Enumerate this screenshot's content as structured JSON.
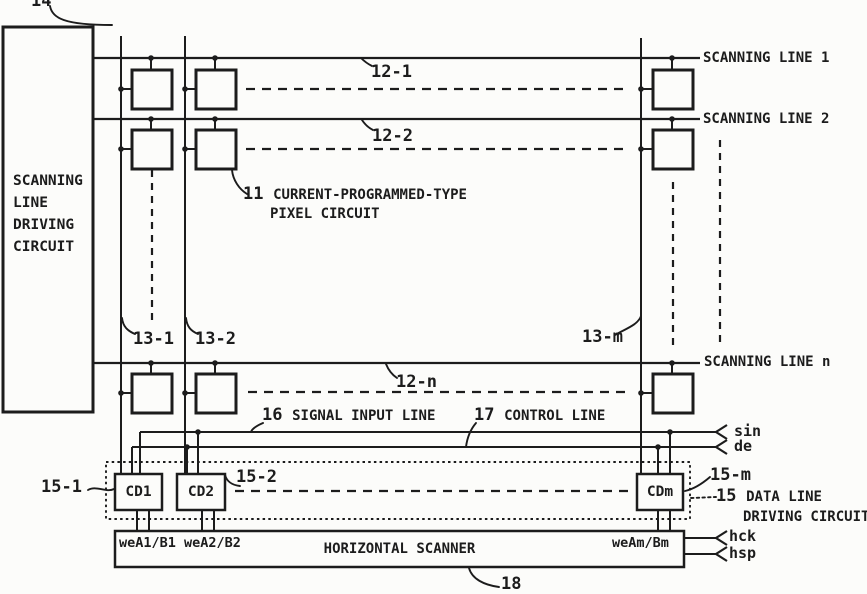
{
  "colors": {
    "ink": "#1c1c1c",
    "paper": "#fcfcfa"
  },
  "references": {
    "r14": "14",
    "r11_num": "11",
    "r11_text": "CURRENT-PROGRAMMED-TYPE",
    "r11_text2": "PIXEL CIRCUIT",
    "r12_1": "12-1",
    "r12_2": "12-2",
    "r12_n": "12-n",
    "r13_1": "13-1",
    "r13_2": "13-2",
    "r13_m": "13-m",
    "r15_1": "15-1",
    "r15_2": "15-2",
    "r15_m": "15-m",
    "r15_num": "15",
    "r15_text": "DATA LINE",
    "r15_text2": "DRIVING CIRCUIT",
    "r16_num": "16",
    "r16_text": "SIGNAL INPUT LINE",
    "r17_num": "17",
    "r17_text": "CONTROL LINE",
    "r18": "18"
  },
  "blocks": {
    "scanning_line_driver": "SCANNING\nLINE\nDRIVING\nCIRCUIT",
    "cd1": "CD1",
    "cd2": "CD2",
    "cdm": "CDm",
    "horizontal_scanner": "HORIZONTAL SCANNER",
    "we_left": "weA1/B1 weA2/B2",
    "we_right": "weAm/Bm"
  },
  "lines": {
    "scanning_line_1": "SCANNING LINE 1",
    "scanning_line_2": "SCANNING LINE 2",
    "scanning_line_n": "SCANNING LINE n"
  },
  "signals": {
    "sin": "sin",
    "de": "de",
    "hck": "hck",
    "hsp": "hsp"
  }
}
